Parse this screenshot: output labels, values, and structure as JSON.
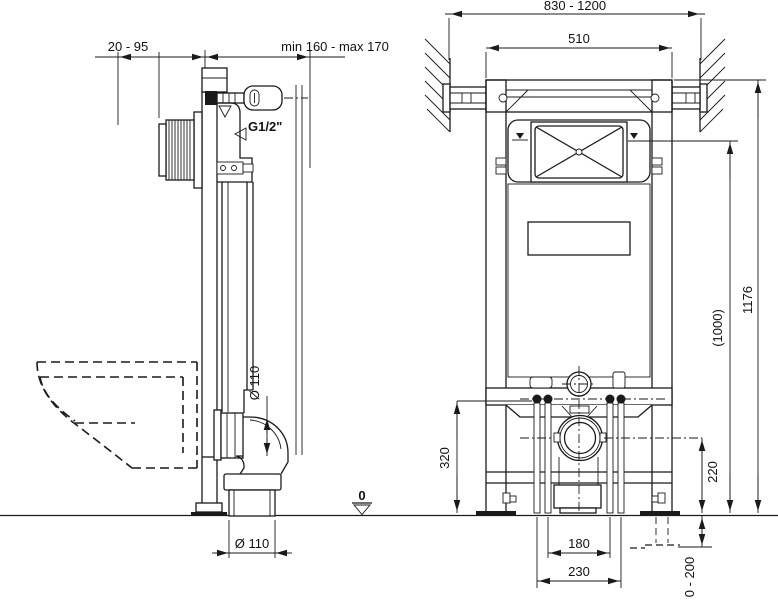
{
  "drawing": {
    "datum_label": "0",
    "line_color": "#1a1a1a",
    "side_view": {
      "dim_wall_offset": "20 - 95",
      "dim_depth": "min 160 - max 170",
      "water_inlet_label": "G1/2\"",
      "outlet_diameter_side": "Ø 110",
      "outlet_diameter_bottom": "Ø 110"
    },
    "front_view": {
      "dim_width_adjustable": "830 - 1200",
      "dim_frame_width": "510",
      "dim_total_height": "1176",
      "dim_flush_plate_height": "(1000)",
      "dim_bolt_height": "320",
      "dim_outlet_center_height": "220",
      "dim_bolt_spacing": "180",
      "dim_leg_spacing": "230",
      "dim_leg_adjust_range": "0 - 200"
    }
  }
}
